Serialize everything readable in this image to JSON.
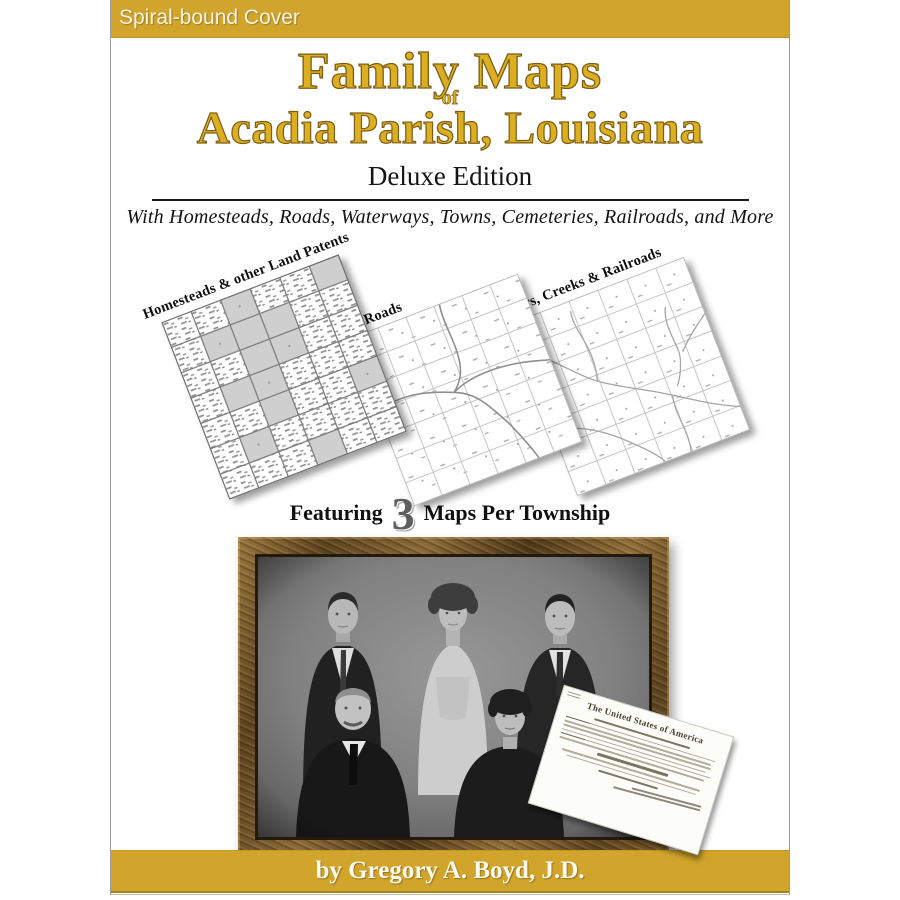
{
  "banner": {
    "label": "Spiral-bound Cover"
  },
  "title": {
    "line1": "Family Maps",
    "connector": "of",
    "line2": "Acadia Parish, Louisiana",
    "edition": "Deluxe Edition",
    "subtitle": "With Homesteads, Roads, Waterways, Towns, Cemeteries, Railroads, and More"
  },
  "maps": {
    "map1_label": "Homesteads & other Land Patents",
    "map2_label": "Roads",
    "map3_label": "Rivers, Creeks & Railroads"
  },
  "featuring": {
    "prefix": "Featuring",
    "number": "3",
    "suffix": "Maps Per Township"
  },
  "document": {
    "heading": "The United States of America"
  },
  "footer": {
    "byline": "by Gregory A. Boyd, J.D."
  },
  "colors": {
    "banner_gold": "#d1a42c",
    "title_gold": "#dcae22",
    "banner_text": "#f8f4e4"
  }
}
